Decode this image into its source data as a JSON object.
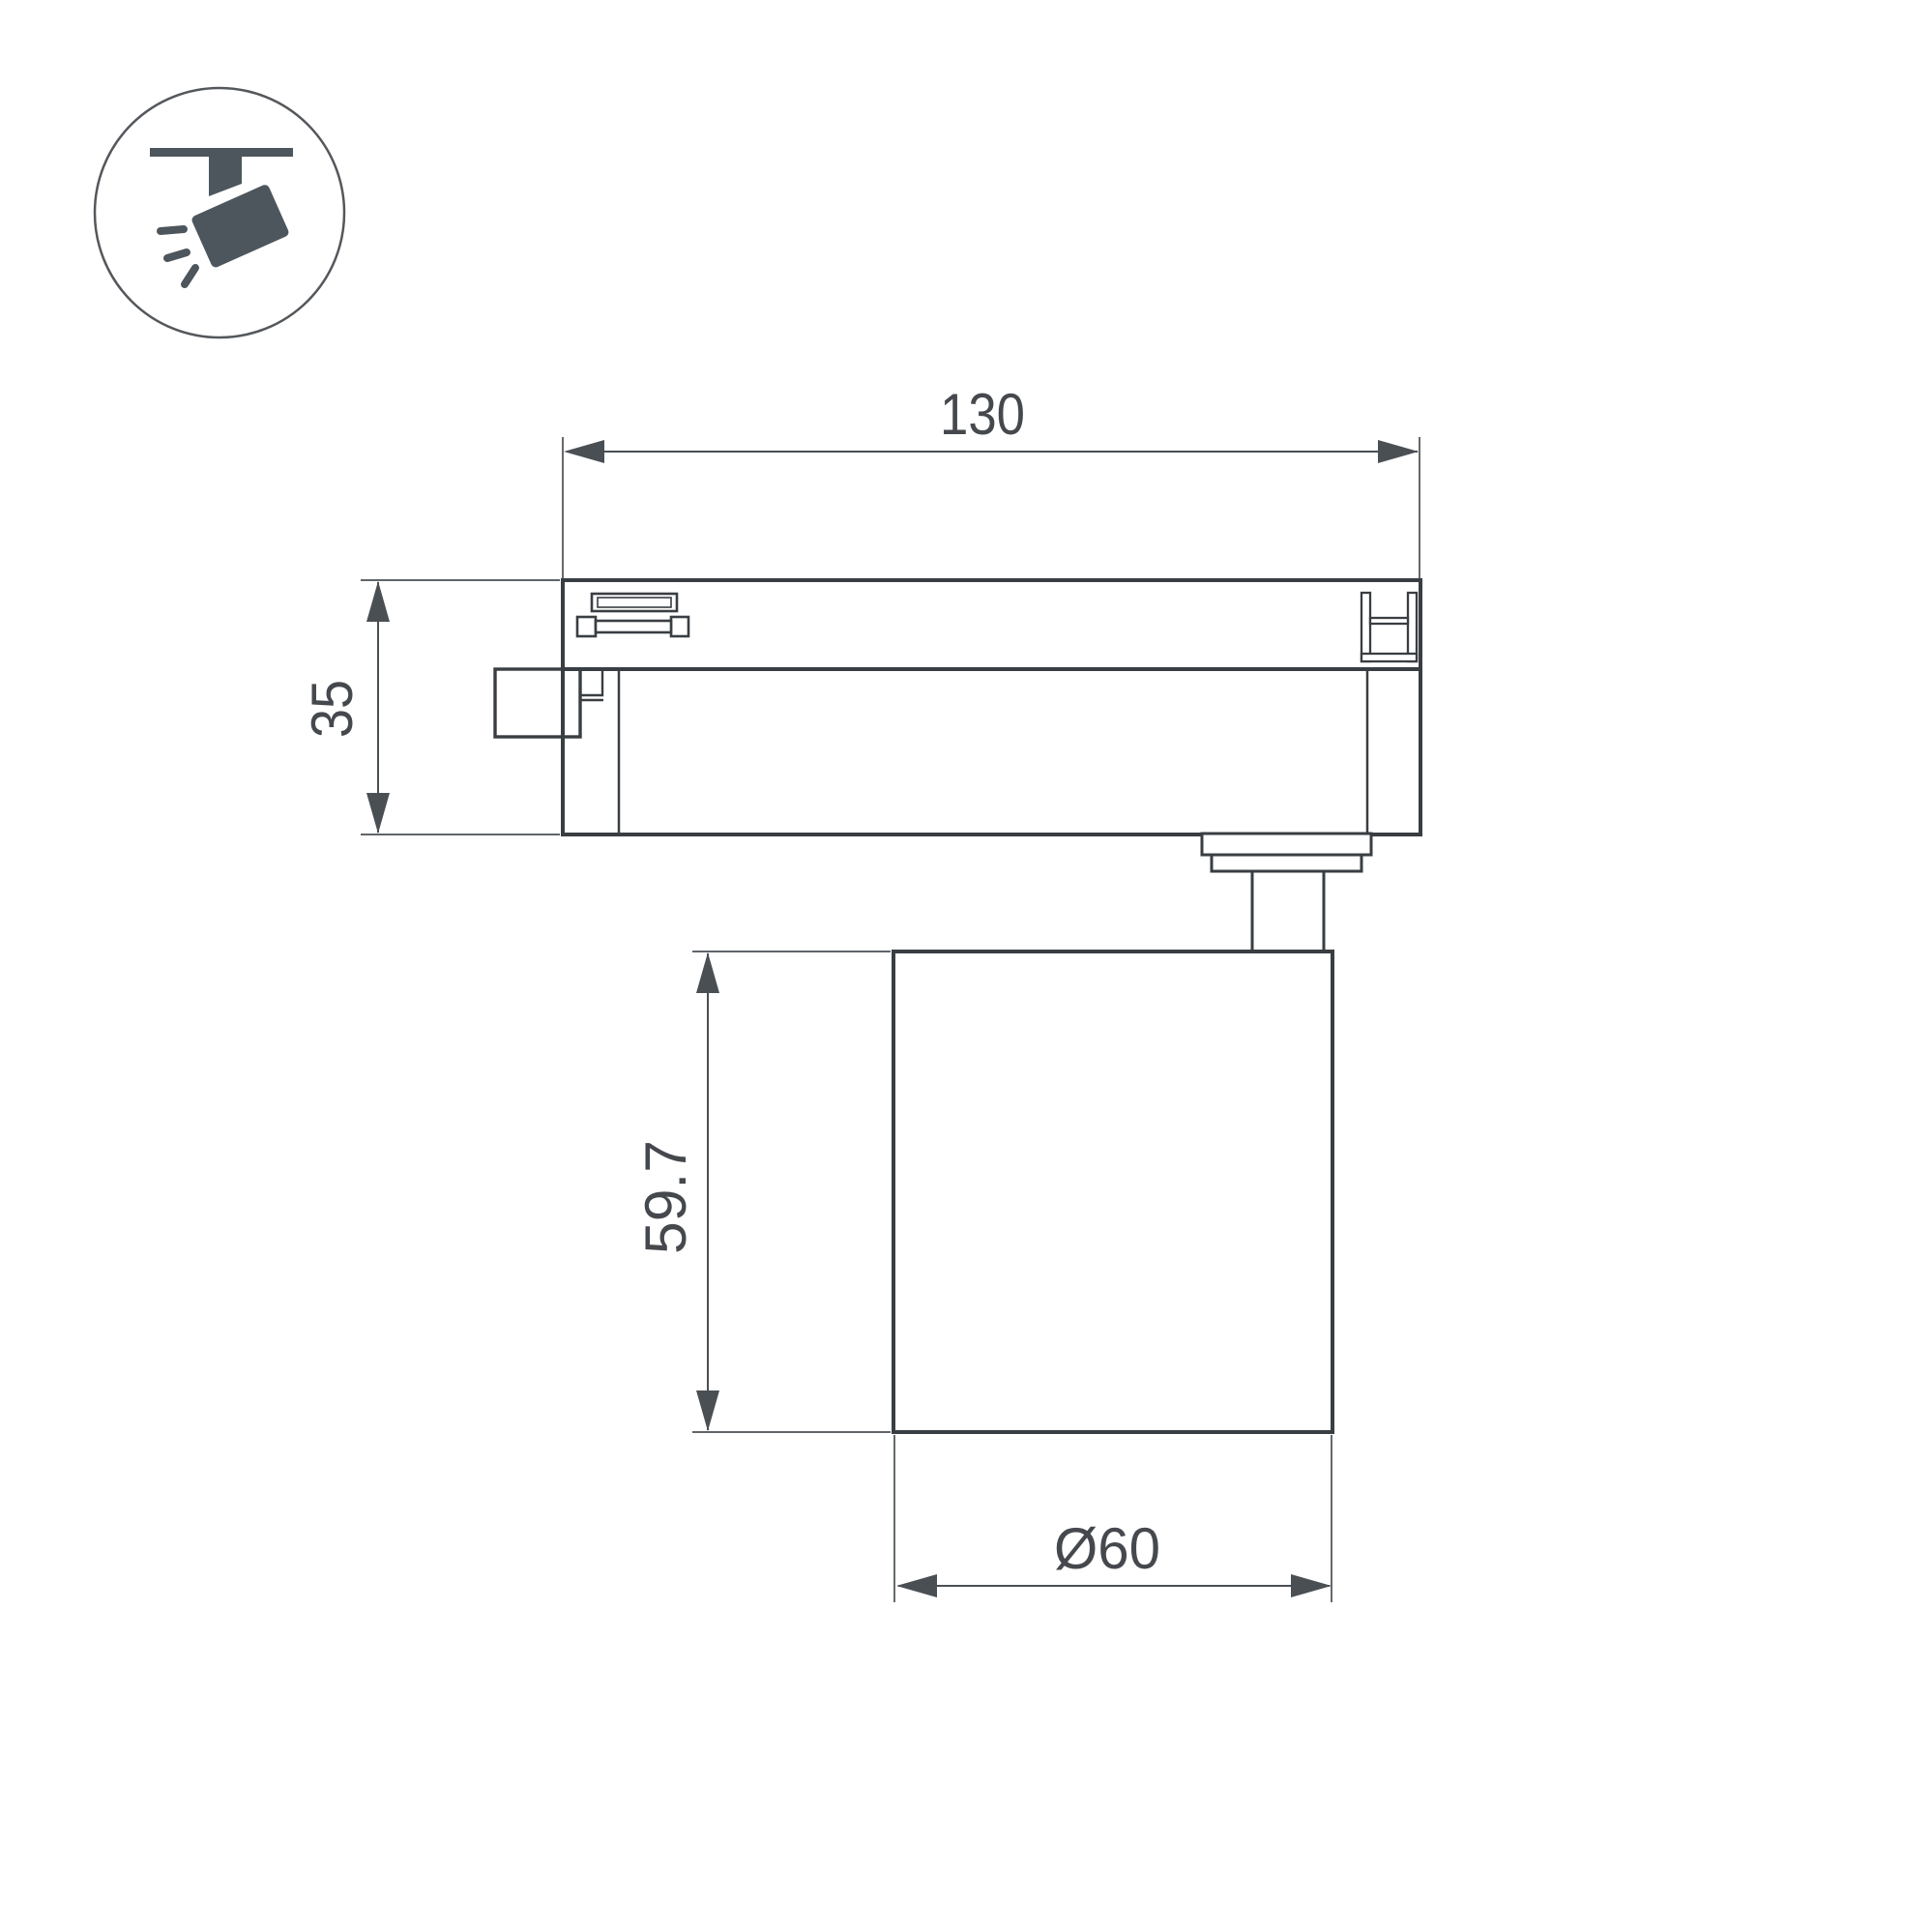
{
  "colors": {
    "background": "#ffffff",
    "outline": "#393e43",
    "dimension": "#4a4f54",
    "icon_fill": "#4d565c"
  },
  "icon": {
    "name": "track-spotlight-icon"
  },
  "dimensions": {
    "track_width": {
      "label": "130"
    },
    "adapter_height": {
      "label": "35"
    },
    "lamp_height": {
      "label": "59.7"
    },
    "lamp_diameter": {
      "label": "Ø60"
    }
  }
}
